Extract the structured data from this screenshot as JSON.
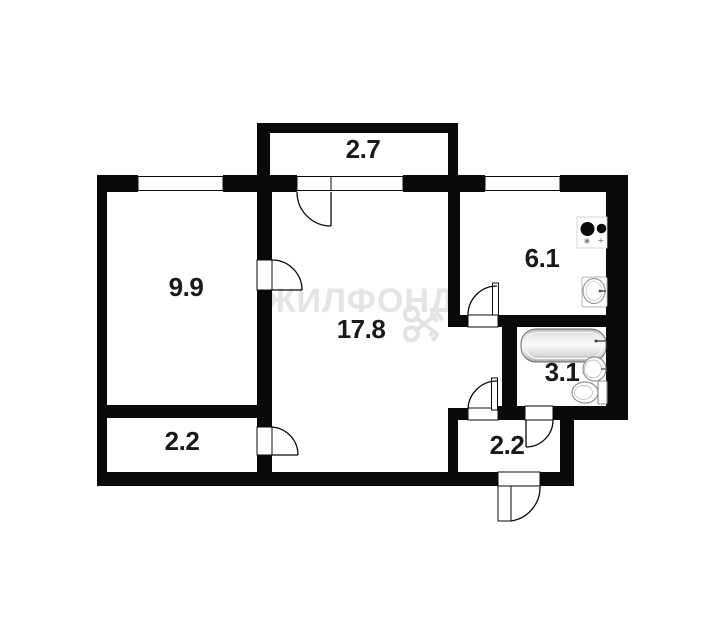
{
  "plan": {
    "type": "apartment-floor-plan",
    "rooms": [
      {
        "name": "balcony",
        "area": "2.7"
      },
      {
        "name": "bedroom",
        "area": "9.9"
      },
      {
        "name": "living-room",
        "area": "17.8"
      },
      {
        "name": "kitchen",
        "area": "6.1"
      },
      {
        "name": "bathroom",
        "area": "3.1"
      },
      {
        "name": "closet",
        "area": "2.2"
      },
      {
        "name": "hallway",
        "area": "2.2"
      }
    ],
    "fixtures": [
      "stove-icon",
      "kitchen-sink-icon",
      "bathtub-icon",
      "washbasin-icon",
      "toilet-icon"
    ]
  },
  "watermark": {
    "text": "ЖИЛФОНД"
  },
  "colors": {
    "wall": "#0a0a0a",
    "background": "#ffffff",
    "label": "#1a1a1a",
    "watermark": "#e4e4e4",
    "fixture_outline": "#8f8f8f"
  }
}
